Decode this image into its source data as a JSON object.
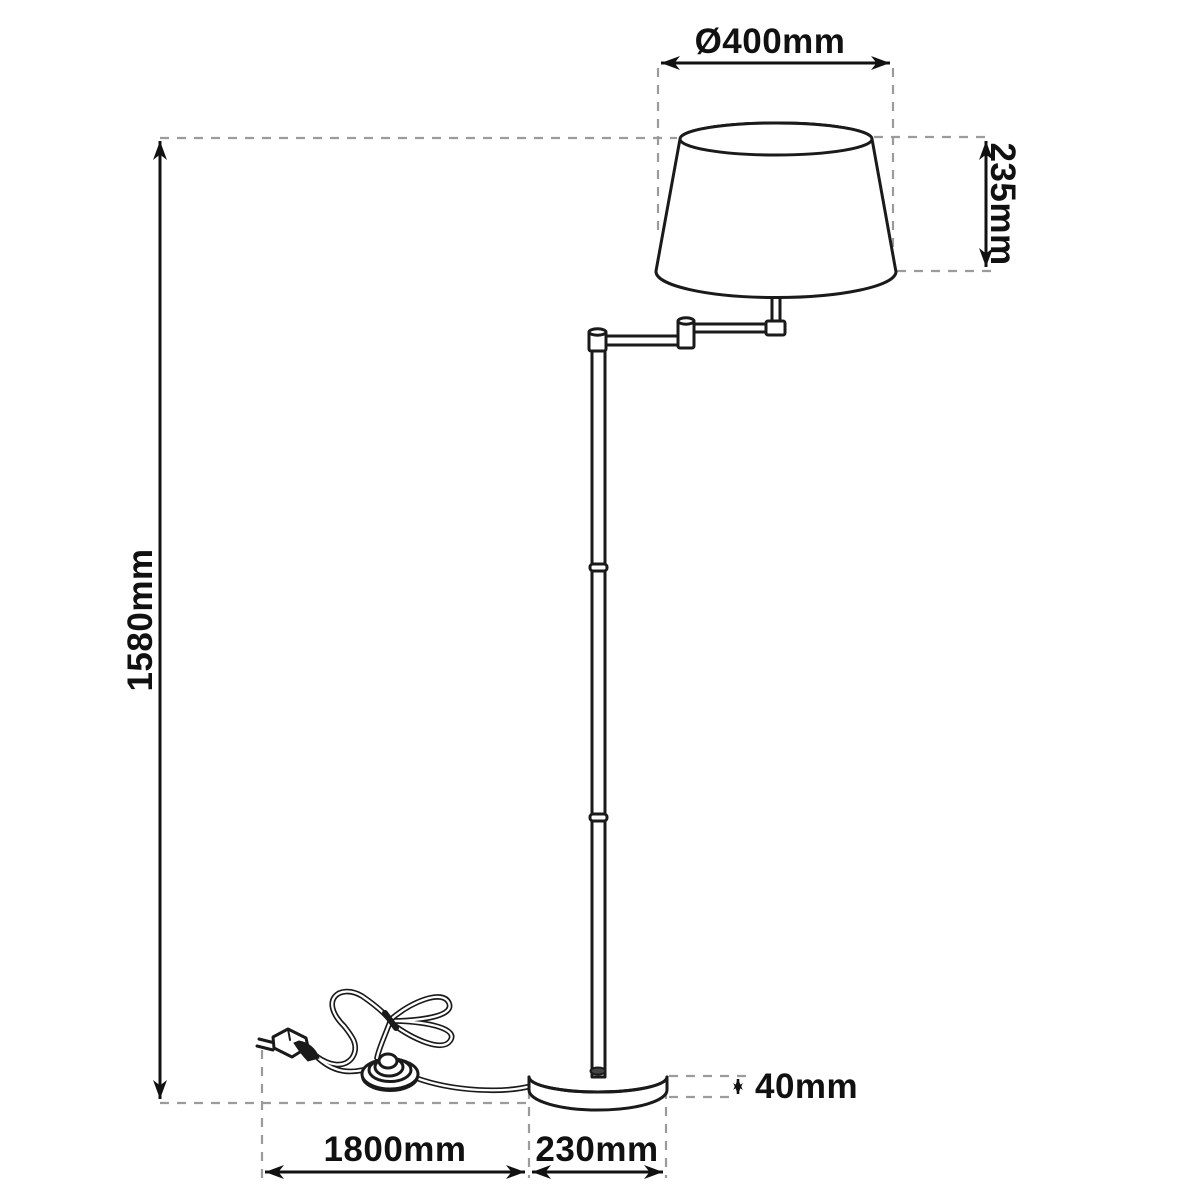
{
  "diagram": {
    "subject": "floor-lamp-technical-dimension-drawing",
    "background_color": "#ffffff",
    "line_color": "#1a1a1a",
    "extension_line_color": "#9b9b9b",
    "dimensions": {
      "shade_diameter": "Ø400mm",
      "shade_height": "235mm",
      "total_height": "1580mm",
      "cable_length": "1800mm",
      "base_diameter": "230mm",
      "base_height": "40mm"
    }
  }
}
